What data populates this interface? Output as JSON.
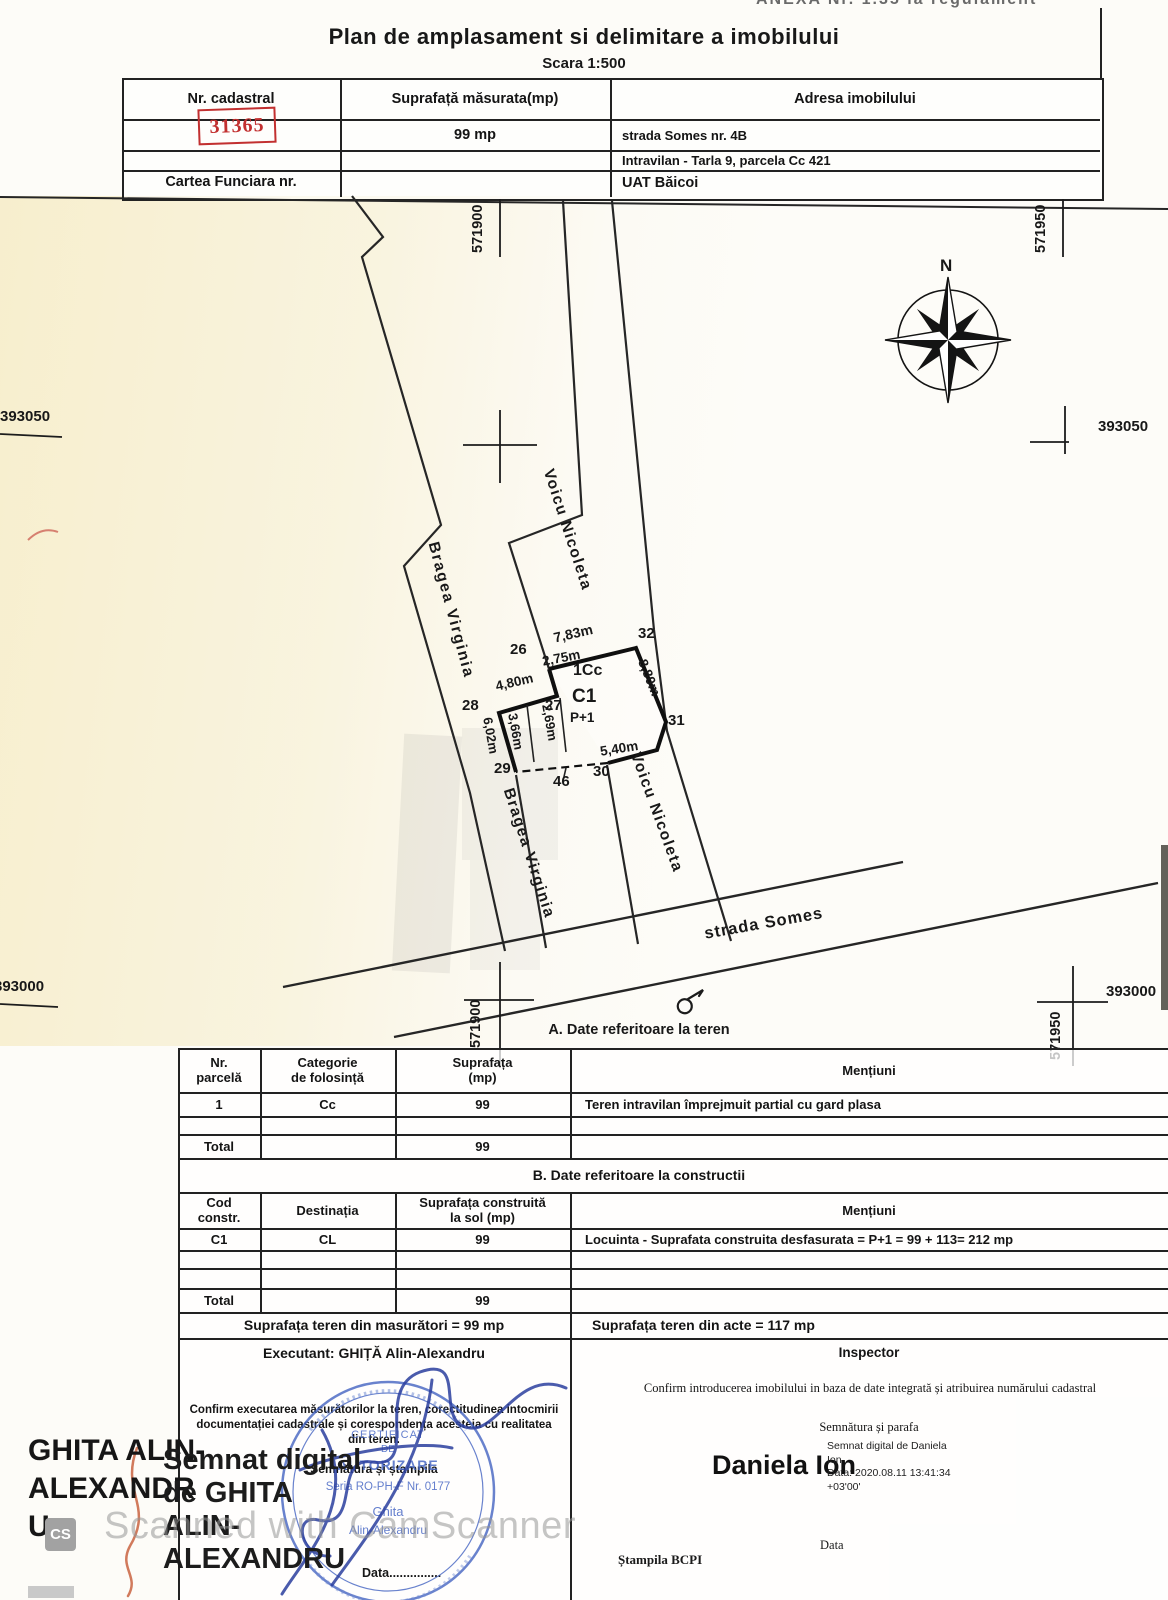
{
  "page": {
    "anexa": "ANEXA Nr. 1.35 la regulament",
    "title": "Plan de amplasament si delimitare a imobilului",
    "scale": "Scara 1:500",
    "watermark_text": "Scanned with CamScanner",
    "watermark_logo": "CS"
  },
  "top_table": {
    "nr_label": "Nr. cadastral",
    "nr_value": "31365",
    "sup_label": "Suprafață măsurata(mp)",
    "sup_value": "99 mp",
    "adr_label": "Adresa imobilului",
    "adr1": "strada Somes nr. 4B",
    "adr2": "Intravilan - Tarla 9, parcela Cc 421",
    "cf_label": "Cartea Funciara nr.",
    "uat": "UAT Băicoi"
  },
  "map": {
    "north": "N",
    "street": "strada Somes",
    "neighbor_left": "Bragea Virginia",
    "neighbor_right": "Voicu Nicoleta",
    "parcel_code": "1Cc",
    "building_code": "C1",
    "building_regime": "P+1",
    "grid_571900": "571900",
    "grid_571950": "571950",
    "grid_393050": "393050",
    "grid_393000": "393000",
    "points": {
      "p26": "26",
      "p27": "27",
      "p28": "28",
      "p29": "29",
      "p30": "30",
      "p31": "31",
      "p32": "32",
      "p46": "46"
    },
    "dims": {
      "top": "7,83m",
      "d275": "2,75m",
      "d480": "4,80m",
      "right": "8,80m",
      "d602": "6,02m",
      "d366": "3,66m",
      "d269": "2,69m",
      "bottom": "5,40m"
    }
  },
  "section_a": {
    "heading": "A. Date referitoare la teren",
    "h1": "Nr.\nparcelă",
    "h2": "Categorie\nde folosință",
    "h3": "Suprafața\n(mp)",
    "h4": "Mențiuni",
    "row": {
      "nr": "1",
      "cat": "Cc",
      "sup": "99",
      "men": "Teren intravilan împrejmuit partial cu gard plasa"
    },
    "total_label": "Total",
    "total_value": "99"
  },
  "section_b": {
    "heading": "B. Date referitoare la constructii",
    "h1": "Cod\nconstr.",
    "h2": "Destinația",
    "h3": "Suprafața construită\nla sol (mp)",
    "h4": "Mențiuni",
    "row": {
      "cod": "C1",
      "dest": "CL",
      "sup": "99",
      "men": "Locuinta - Suprafata construita desfasurata = P+1 = 99 + 113= 212 mp"
    },
    "total_label": "Total",
    "total_value": "99",
    "masuratori": "Suprafața teren din masurători = 99 mp",
    "acte": "Suprafața teren din acte = 117 mp"
  },
  "footer": {
    "executant": "Executant:  GHIȚĂ Alin-Alexandru",
    "confirm_left": "Confirm executarea măsurătorilor la teren, corectitudinea intocmirii\ndocumentației cadastrale și corespondența acesteia cu realitatea\ndin teren.",
    "semnatura_left": "Semnătura și ștampila",
    "data_left": "Data...............",
    "inspector": "Inspector",
    "confirm_right": "Confirm introducerea imobilului in baza de date integrată și atribuirea numărului cadastral",
    "semnatura_right": "Semnătura și parafa",
    "signer_name": "Daniela Ion",
    "signer_details": "Semnat digital de Daniela\nIon\nData: 2020.08.11 13:41:34\n+03'00'",
    "data_right": "Data",
    "stampila": "Ștampila BCPI"
  },
  "overlay": {
    "big_name": "GHITA ALIN-\nALEXANDR\nU",
    "digital_note": "Semnat digital\nde GHITA\nALIN-\nALEXANDRU",
    "stamp": {
      "l1": "CERTIFICAT",
      "l2": "DE",
      "l3": "AUTORIZARE",
      "l4": "Seria RO-PH-F Nr. 0177",
      "l5": "Ghita",
      "l6": "Alin-Alexandru"
    }
  }
}
